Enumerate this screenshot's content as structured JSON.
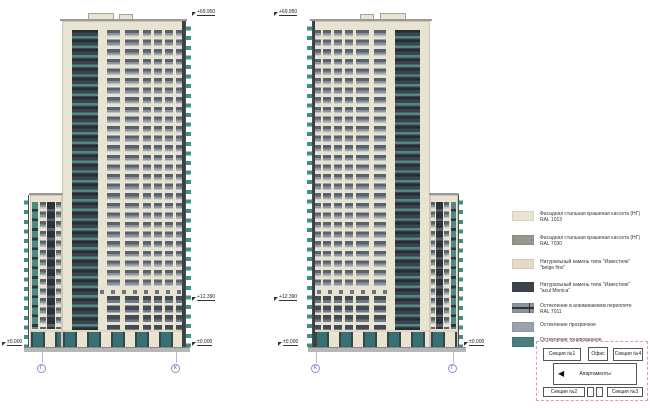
{
  "elevations": [
    {
      "top_mark": "+69.950",
      "mid_mark": "+12.390",
      "zero_mark": "±0.000",
      "axes": [
        "Г",
        "К"
      ]
    },
    {
      "top_mark": "+69.950",
      "mid_mark": "+12.390",
      "zero_mark": "±0.000",
      "axes": [
        "К",
        "Г"
      ]
    }
  ],
  "legend": {
    "items": [
      {
        "line1": "Фасадная стальная крашеная кассета (НГ)",
        "line2": "RAL 1013",
        "color": "#e9e3d2"
      },
      {
        "line1": "Фасадная стальная крашеная кассета (НГ)",
        "line2": "RAL 7030",
        "color": "#99958a"
      },
      {
        "line1": "Натуральный камень типа \"Известняк\"",
        "line2": "\"beige fino\"",
        "color": "#e3dbc6"
      },
      {
        "line1": "Натуральный камень типа \"Известняк\"",
        "line2": "\"azul Monica\"",
        "color": "#3c434c"
      },
      {
        "line1": "Остекление в алюминиевом переплете",
        "line2": "RAL 7011",
        "color": "#8b939c"
      },
      {
        "line1": "Остекление прозрачное",
        "line2": "",
        "color": "#9aa3ab"
      },
      {
        "line1": "Остекление тонированное",
        "line2": "RAL 5021",
        "color": "#4a7e7e"
      }
    ]
  },
  "keyplan": {
    "arrow": "◀",
    "boxes": [
      "Секция №1",
      "Офис",
      "Секция №4",
      "Апартаменты",
      "Секция №2",
      "Секция №3"
    ]
  },
  "colors": {
    "facade_beige": "#e9e3d2",
    "facade_gray": "#99958a",
    "stone_dark": "#3c434c",
    "glazing_tinted": "#4a7e7e",
    "axis_blue": "#8f8fd0",
    "keyplan_border": "#ef93a5"
  }
}
